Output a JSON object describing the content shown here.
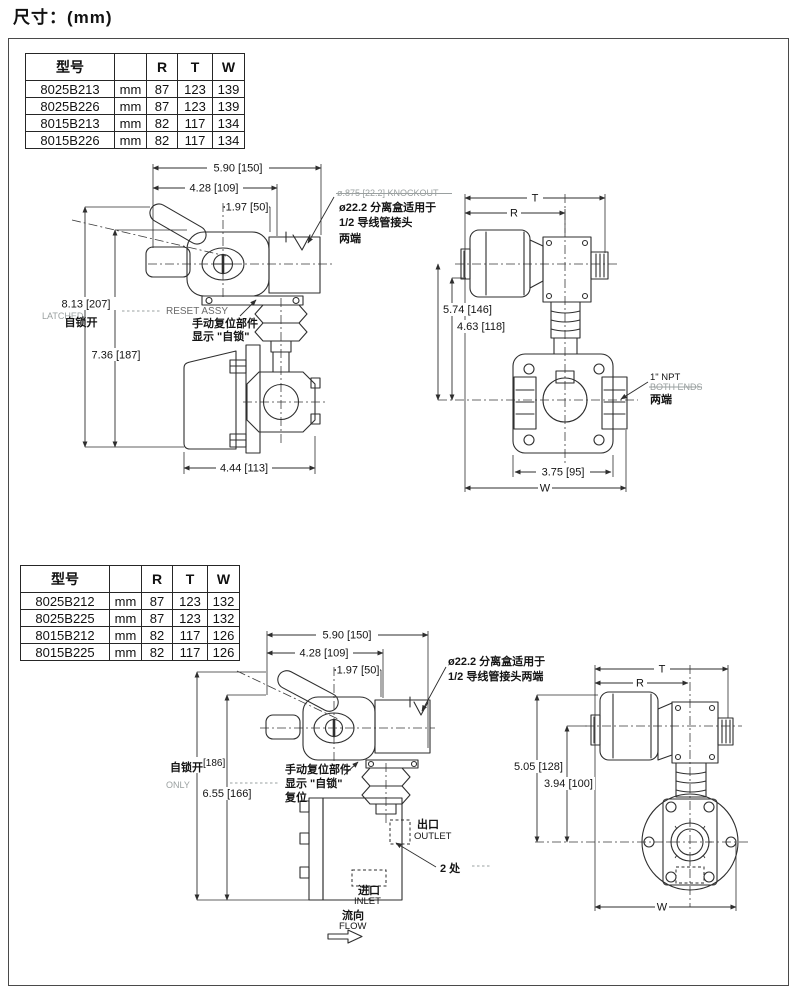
{
  "page": {
    "title": "尺寸：(mm)",
    "ink": "#2e2e2e",
    "paper": "#ffffff"
  },
  "tables": {
    "top": {
      "headers": [
        "型号",
        "",
        "R",
        "T",
        "W"
      ],
      "rows": [
        [
          "8025B213",
          "mm",
          "87",
          "123",
          "139"
        ],
        [
          "8025B226",
          "mm",
          "87",
          "123",
          "139"
        ],
        [
          "8015B213",
          "mm",
          "82",
          "117",
          "134"
        ],
        [
          "8015B226",
          "mm",
          "82",
          "117",
          "134"
        ]
      ]
    },
    "bottom": {
      "headers": [
        "型号",
        "",
        "R",
        "T",
        "W"
      ],
      "rows": [
        [
          "8025B212",
          "mm",
          "87",
          "123",
          "132"
        ],
        [
          "8025B225",
          "mm",
          "87",
          "123",
          "132"
        ],
        [
          "8015B212",
          "mm",
          "82",
          "117",
          "126"
        ],
        [
          "8015B225",
          "mm",
          "82",
          "117",
          "126"
        ]
      ]
    }
  },
  "drawing_top_left": {
    "dim_w_overall": "5.90 [150]",
    "dim_w_body": "4.28 [109]",
    "dim_w_center": "1.97 [50]",
    "dim_h_latched": "8.13 [207]",
    "latched_en": "LATCHED",
    "latched_cn": "自锁开",
    "dim_h": "7.36 [187]",
    "reset_en": "RESET ASSY",
    "reset_cn_1": "手动复位部件",
    "reset_cn_2": "显示 \"自锁\"",
    "knockout_en": "ø.875 [22.2] KNOCKOUT",
    "knockout_cn_1": "ø22.2 分离盒适用于",
    "knockout_cn_2": "1/2 导线管接头",
    "knockout_cn_3": "两端",
    "dim_base": "4.44 [113]"
  },
  "drawing_top_right": {
    "dim_t": "T",
    "dim_r": "R",
    "dim_h1": "5.74 [146]",
    "dim_h2": "4.63 [118]",
    "npt_en1": "1\" NPT",
    "npt_en2": "BOTH ENDS",
    "npt_cn": "两端",
    "dim_flange": "3.75 [95]",
    "dim_w": "W"
  },
  "drawing_bottom_left": {
    "dim_w_overall": "5.90 [150]",
    "dim_w_body": "4.28 [109]",
    "dim_w_center": "1.97 [50]",
    "knockout_cn_1": "ø22.2 分离盒适用于",
    "knockout_cn_2": "1/2 导线管接头两端",
    "latched_cn": "自锁开",
    "dim_latched": "[186]",
    "only_en": "ONLY",
    "dim_h": "6.55 [166]",
    "reset_cn_1": "手动复位部件",
    "reset_cn_2": "显示 \"自锁\"",
    "reset_cn_3": "复位",
    "outlet_cn": "出口",
    "outlet_en": "OUTLET",
    "places": "2 处",
    "inlet_cn": "进口",
    "inlet_en": "INLET",
    "flow_cn": "流向",
    "flow_en": "FLOW"
  },
  "drawing_bottom_right": {
    "dim_t": "T",
    "dim_r": "R",
    "dim_h1": "5.05 [128]",
    "dim_h2": "3.94 [100]",
    "dim_w": "W"
  }
}
